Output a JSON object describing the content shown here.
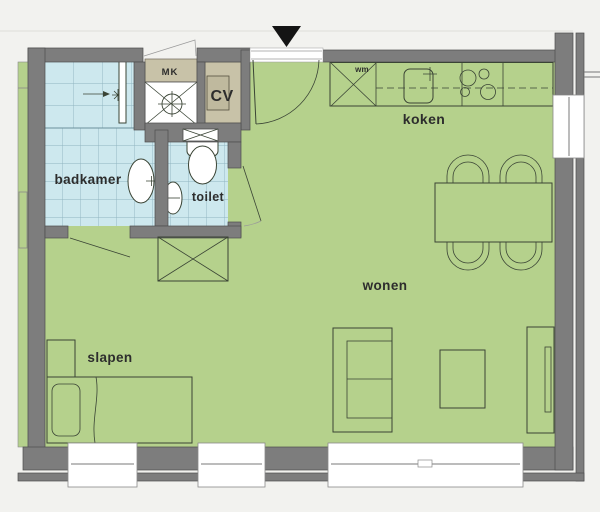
{
  "plan_title": "Apartment floor plan",
  "rooms": {
    "badkamer": {
      "label": "badkamer"
    },
    "toilet": {
      "label": "toilet"
    },
    "koken": {
      "label": "koken"
    },
    "wonen": {
      "label": "wonen"
    },
    "slapen": {
      "label": "slapen"
    }
  },
  "closets": {
    "mk": {
      "label": "MK"
    },
    "cv": {
      "label": "CV"
    }
  },
  "appliances": {
    "wm": {
      "label": "wm"
    }
  },
  "icons": {
    "entrance_marker": "black-triangle-down"
  },
  "colors": {
    "background": "#f2f2ef",
    "floor": "#b5d18c",
    "tile": "#cde8ee",
    "tile_line": "#8fb3c0",
    "wall": "#7d7d7d",
    "wall_edge": "#4d4d4d",
    "closet": "#c8c2a8",
    "line": "#3a4435",
    "text": "#2d2d2d",
    "frame": "#8a8a8a"
  }
}
